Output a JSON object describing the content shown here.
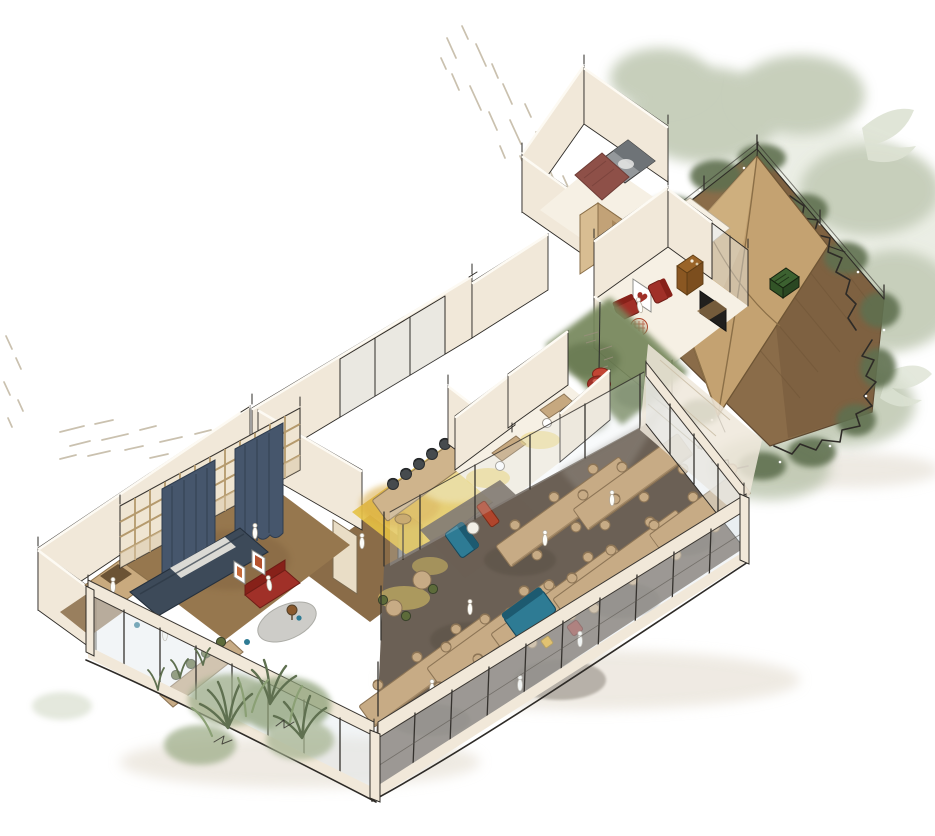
{
  "scene": {
    "title": "Hand-drawn axonometric cutaway sketch of an office interior with garden terrace",
    "type": "architectural-axonometric-sketch",
    "style": "ink and watercolor",
    "palette": {
      "paper": "#ffffff",
      "ink": "#2e2b27",
      "wall": "#f1e8d9",
      "wallTop": "#fdfaf3",
      "wallLight": "#f6f0e4",
      "wood": "#c7ab85",
      "woodDark": "#8d7556",
      "floorBrown": "#96774e",
      "floorTaupe": "#6b6055",
      "corridorBrown": "#8a6c48",
      "yellow": "#e5c245",
      "yellowSoft": "#f0df9f",
      "moss": "#76875c",
      "mossDark": "#5d6e46",
      "sage": "#b9c3ab",
      "sageLight": "#d5dcc9",
      "foliageDark": "#5f7050",
      "navy": "#46566c",
      "navyDark": "#39485b",
      "red": "#a03028",
      "redDark": "#872119",
      "teal": "#2e7b94",
      "tealDark": "#1d5a70",
      "orange": "#b0452c",
      "accentYellow": "#e2a81a",
      "maroon": "#8c3a33",
      "glass": "#dfe8ec",
      "deck": "#8a6c49",
      "deckDark": "#75593a",
      "canopy": "#c4a271",
      "canopyDark": "#8b6f47",
      "gray": "#94989b",
      "grayDark": "#6e7377",
      "bathMaroon": "#8e5048",
      "rug": "#cbcac6",
      "greenChair": "#5d6b3a",
      "crate": "#3c6130"
    },
    "rooms": [
      {
        "name": "garden-terrace",
        "floor": "brown deck",
        "features": [
          "canvas canopy",
          "green crate bench",
          "hedge with ink scribbles",
          "sage foliage"
        ]
      },
      {
        "name": "service-block",
        "features": [
          "gray shower stall",
          "maroon bathroom floor",
          "tan joinery core"
        ]
      },
      {
        "name": "lounge-room",
        "features": [
          "2 red armchairs",
          "patterned pouf",
          "heart artwork",
          "tv screen",
          "brown cabinet"
        ]
      },
      {
        "name": "green-corridor",
        "features": [
          "moss green wall-floor wash",
          "red pendant lamp"
        ]
      },
      {
        "name": "meeting-room",
        "floor": "yellow",
        "features": [
          "long table",
          "6 dark chairs",
          "wall screen",
          "glazed back wall"
        ]
      },
      {
        "name": "focus-rooms",
        "count": 2,
        "features": [
          "desk",
          "white chair",
          "yellow floor glow"
        ]
      },
      {
        "name": "open-plan-hall",
        "floor": "dark taupe",
        "features": [
          "7 long work tables",
          "office chairs",
          "teal sofa",
          "teal and orange booth",
          "floor lamps",
          "glazed facade"
        ]
      },
      {
        "name": "left-lounge",
        "features": [
          "timber grid wall",
          "navy curtains",
          "navy daybed",
          "red sofa",
          "2 framed artworks",
          "round gray rug",
          "dining table with green chairs",
          "reading nook",
          "indoor planters"
        ]
      }
    ],
    "furniture_counts": {
      "hall_work_tables": 7,
      "hall_office_chairs": 38,
      "meeting_chairs": 6,
      "green_chairs": 4,
      "red_armchairs": 2,
      "sofas_red": 1,
      "sofas_teal": 1,
      "booths": 2,
      "framed_artworks": 3,
      "pendant_lamps": 1,
      "floor_lamps": 1,
      "people_figures": 11
    },
    "garden": {
      "deck_color": "#8a6c49",
      "canopy_color": "#c4a271",
      "hedge": "dark green with black ink scribbles",
      "crate_color": "#3c6130"
    },
    "sketch_marks": {
      "hatch_clusters": 4,
      "color": "#b4a68d"
    }
  }
}
